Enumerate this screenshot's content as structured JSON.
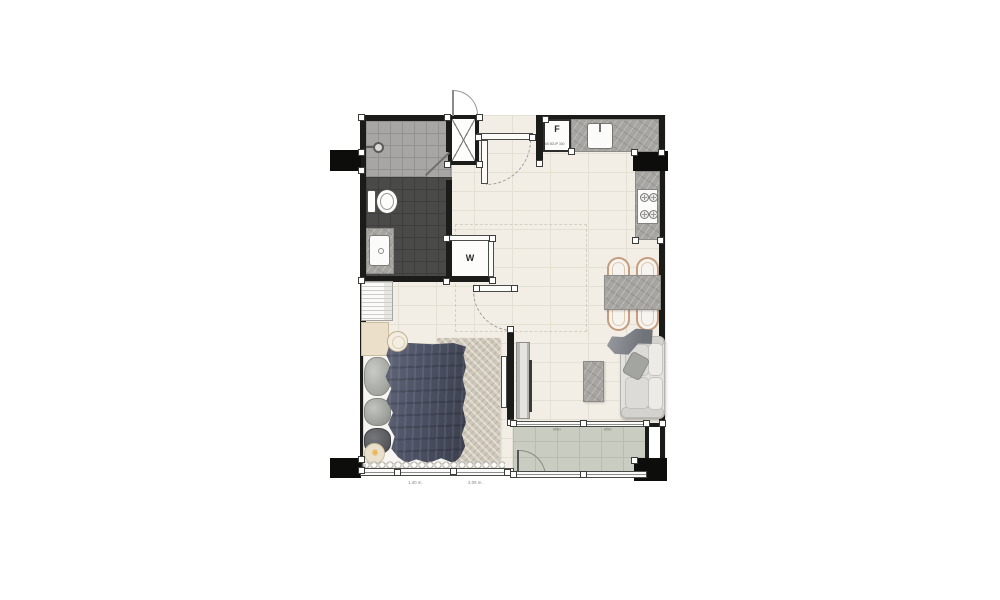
{
  "labels": {
    "fridge": "F",
    "fridge_note": "65 50UP 300",
    "washer": "W"
  },
  "annotations": {
    "bedroom_window_dim_left": "1.40 m.",
    "bedroom_window_dim_right": "2.05 m.",
    "balcony_mark_left": "Ø50",
    "balcony_mark_right": "Ø50"
  },
  "colors": {
    "wall": "#1b1b19",
    "column": "#0d0d0b",
    "floor": "#f2eee5",
    "floor_line": "#e5e0d4",
    "shower": "#a7a6a4",
    "shower_line": "#949391",
    "wc": "#4a4a48",
    "wc_line": "#3e3e3c",
    "balcony": "#c9cdc1",
    "balcony_line": "#b9bdb1",
    "counter": "#a7a5a1",
    "duvet": "#4d5260",
    "chair": "#c49d7f",
    "rug": "#cfc8b9"
  }
}
